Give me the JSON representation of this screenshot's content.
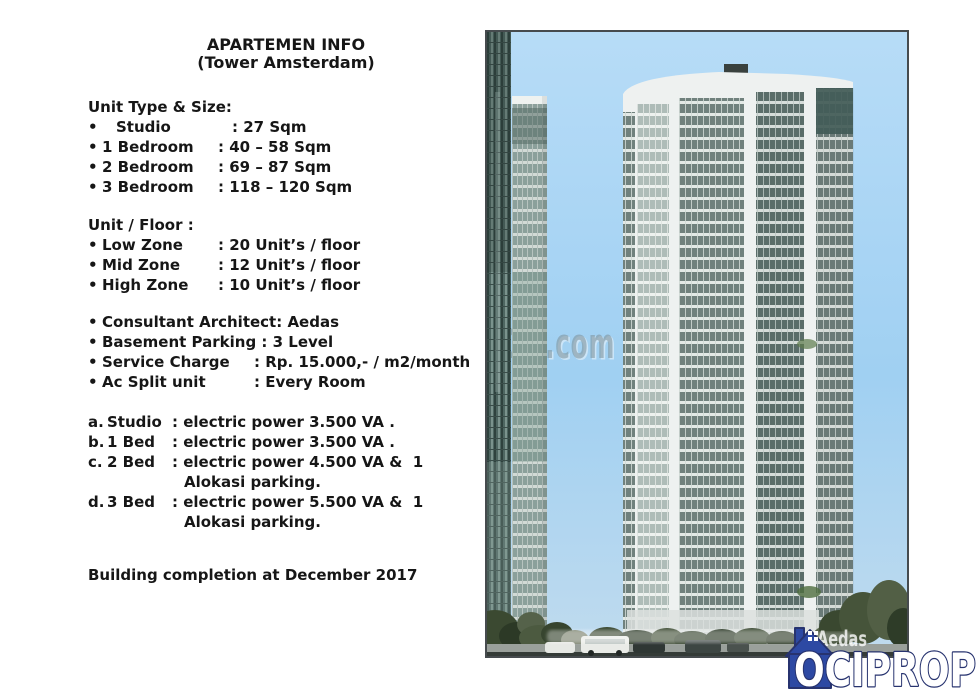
{
  "flyer": {
    "title": "APARTEMEN INFO",
    "subtitle": "(Tower Amsterdam)",
    "unit_type": {
      "heading": "Unit Type & Size:",
      "items": [
        {
          "bullet": "•",
          "label": "Studio",
          "value": ": 27 Sqm"
        },
        {
          "bullet": "•",
          "label": "1 Bedroom",
          "value": ": 40 – 58 Sqm"
        },
        {
          "bullet": "•",
          "label": "2 Bedroom",
          "value": ": 69 – 87 Sqm"
        },
        {
          "bullet": "•",
          "label": "3 Bedroom",
          "value": ": 118 – 120 Sqm"
        }
      ]
    },
    "unit_floor": {
      "heading": "Unit / Floor :",
      "items": [
        {
          "bullet": "•",
          "label": "Low Zone",
          "value": ": 20 Unit’s / floor"
        },
        {
          "bullet": "•",
          "label": "Mid Zone",
          "value": ": 12 Unit’s / floor"
        },
        {
          "bullet": "•",
          "label": "High Zone",
          "value": ": 10 Unit’s / floor"
        }
      ]
    },
    "facilities": {
      "items": [
        {
          "bullet": "•",
          "label": "Consultant Architect: Aedas",
          "value": ""
        },
        {
          "bullet": "•",
          "label": "Basement Parking : 3 Level",
          "value": ""
        },
        {
          "bullet": "•",
          "label": "Service Charge",
          "value": ": Rp. 15.000,- / m2/month"
        },
        {
          "bullet": "•",
          "label": "Ac Split unit",
          "value": ": Every Room"
        }
      ]
    },
    "electric": {
      "items": [
        {
          "prefix": "a.",
          "label": "Studio",
          "value": ": electric power 3.500 VA ."
        },
        {
          "prefix": "b.",
          "label": "1 Bed",
          "value": ": electric power 3.500 VA ."
        },
        {
          "prefix": "c.",
          "label": "2 Bed",
          "value": ": electric power 4.500 VA &  1\nAlokasi parking."
        },
        {
          "prefix": "d.",
          "label": "3 Bed",
          "value": ": electric power 5.500 VA &  1\nAlokasi parking."
        }
      ]
    },
    "completion": "Building completion at December 2017"
  },
  "rendering": {
    "watermark_center": "123.com",
    "watermark_architect": "Aedas"
  },
  "logo": {
    "text": "OCIPROP",
    "house_color": "#2d49a3",
    "outline_color": "#27336f"
  }
}
